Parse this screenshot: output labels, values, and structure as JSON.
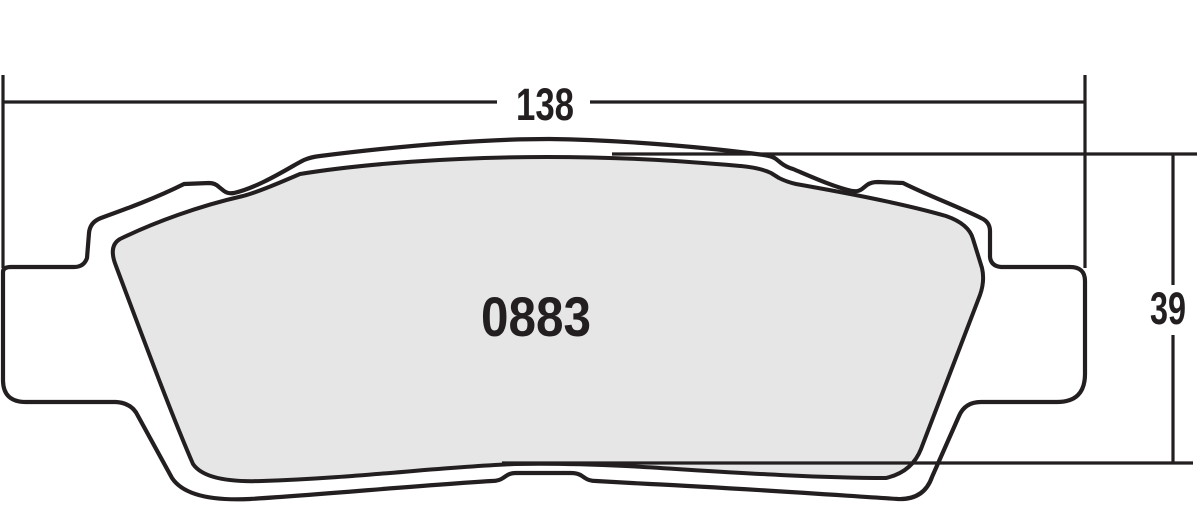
{
  "diagram": {
    "part_number": "0883",
    "width_dimension": "138",
    "height_dimension": "39"
  },
  "colors": {
    "line": "#231f20",
    "text": "#231f20",
    "plate_fill": "#ffffff",
    "friction_fill": "#e6e6e6",
    "background": "#ffffff"
  }
}
